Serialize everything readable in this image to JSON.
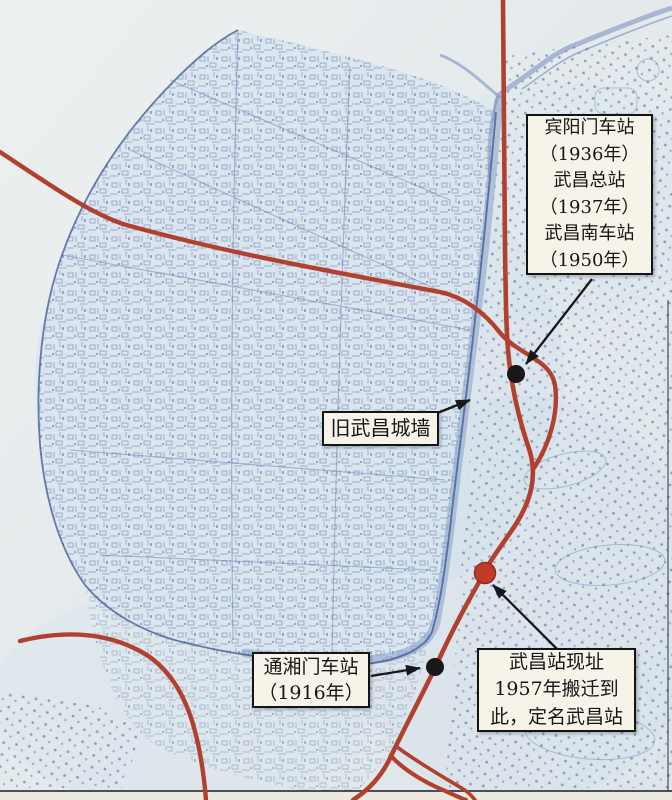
{
  "map": {
    "boxes": {
      "binyangmen": {
        "lines": [
          "宾阳门车站",
          "（1936年）",
          "武昌总站",
          "（1937年）",
          "武昌南车站",
          "（1950年）"
        ]
      },
      "old_wall": {
        "lines": [
          "旧武昌城墙"
        ]
      },
      "tongxiangmen": {
        "lines": [
          "通湘门车站",
          "（1916年）"
        ]
      },
      "wuchang_current": {
        "lines": [
          "武昌站现址",
          "1957年搬迁到",
          "此，定名武昌站"
        ]
      }
    },
    "markers": [
      {
        "name": "binyangmen-station-dot",
        "x": 516,
        "y": 374,
        "r": 9,
        "color": "#181818",
        "stroke": "none"
      },
      {
        "name": "tongxiangmen-station-dot",
        "x": 435,
        "y": 667,
        "r": 9,
        "color": "#181818",
        "stroke": "none"
      },
      {
        "name": "wuchang-station-current-dot",
        "x": 485,
        "y": 573,
        "r": 10.5,
        "color": "#c23b28",
        "stroke": "#8d2b1d"
      }
    ],
    "arrows": [
      {
        "name": "arrow-to-binyangmen-dot",
        "x1": 592,
        "y1": 279,
        "x2": 526,
        "y2": 364
      },
      {
        "name": "arrow-to-old-wall",
        "x1": 430,
        "y1": 416,
        "x2": 470,
        "y2": 400
      },
      {
        "name": "arrow-to-tongxiangmen-dot",
        "x1": 371,
        "y1": 676,
        "x2": 420,
        "y2": 668
      },
      {
        "name": "arrow-to-wuchang-current-dot",
        "x1": 557,
        "y1": 649,
        "x2": 493,
        "y2": 585
      }
    ],
    "colors": {
      "railway_red": "#b2402f",
      "marker_black": "#181818",
      "marker_red": "#c23b28",
      "box_background": "#f6f3e9",
      "box_border": "#141414",
      "map_ink_blue": "#4c639e",
      "paper": "#e8eced"
    }
  }
}
